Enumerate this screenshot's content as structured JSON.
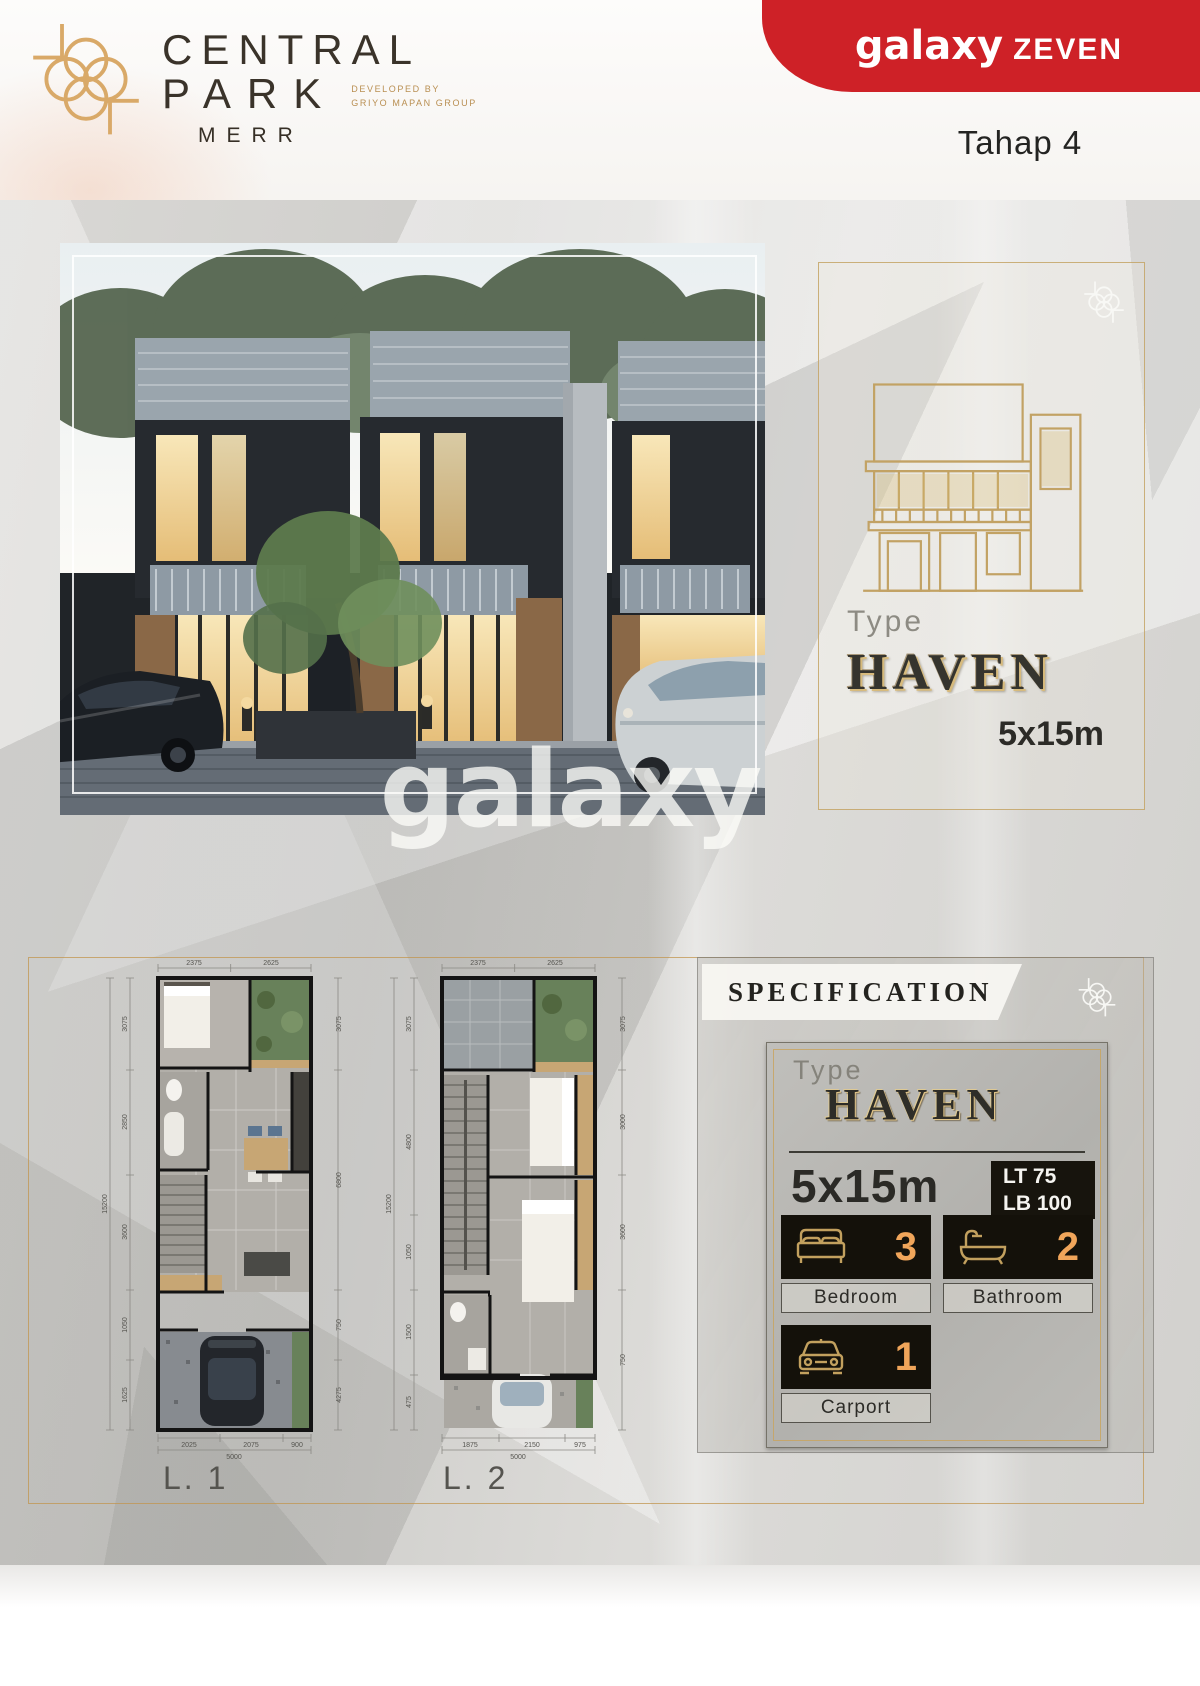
{
  "colors": {
    "accent_red": "#ce2127",
    "gold": "#c2a05e",
    "dark_text": "#24231f",
    "number_orange": "#f0a55a"
  },
  "header": {
    "logo_line1": "CENTRAL",
    "logo_line2": "PARK",
    "logo_sub": "MERR",
    "developed_by": "DEVELOPED BY",
    "developer": "GRIYO MAPAN GROUP",
    "brand_primary": "galaxy",
    "brand_secondary": "ZEVEN",
    "phase": "Tahap 4"
  },
  "hero": {
    "type_label": "Type",
    "type_name": "HAVEN",
    "size": "5x15m",
    "watermark": "galaxy"
  },
  "plans": {
    "l1": {
      "label": "L. 1",
      "dims_top": [
        "2375",
        "2625"
      ],
      "dims_left": [
        "3075",
        "2850",
        "3600",
        "1050",
        "1625"
      ],
      "dims_left_total": "15200",
      "dims_right": [
        "3075",
        "6800",
        "750",
        "4275"
      ],
      "dims_bottom": [
        "2025",
        "2075",
        "900"
      ],
      "dims_bottom_total": "5000"
    },
    "l2": {
      "label": "L. 2",
      "dims_top": [
        "2375",
        "2625"
      ],
      "dims_left": [
        "3075",
        "4800",
        "1050",
        "1500",
        "475"
      ],
      "dims_left_total": "15200",
      "dims_right": [
        "3075",
        "3000",
        "3600",
        "750"
      ],
      "dims_bottom": [
        "1875",
        "2150",
        "975"
      ],
      "dims_bottom_total": "5000"
    }
  },
  "specification": {
    "title": "SPECIFICATION",
    "type_label": "Type",
    "type_name": "HAVEN",
    "size": "5x15m",
    "lt": "LT 75",
    "lb": "LB 100",
    "features": [
      {
        "name": "bedroom",
        "count": "3",
        "label": "Bedroom"
      },
      {
        "name": "bathroom",
        "count": "2",
        "label": "Bathroom"
      },
      {
        "name": "carport",
        "count": "1",
        "label": "Carport"
      }
    ]
  }
}
